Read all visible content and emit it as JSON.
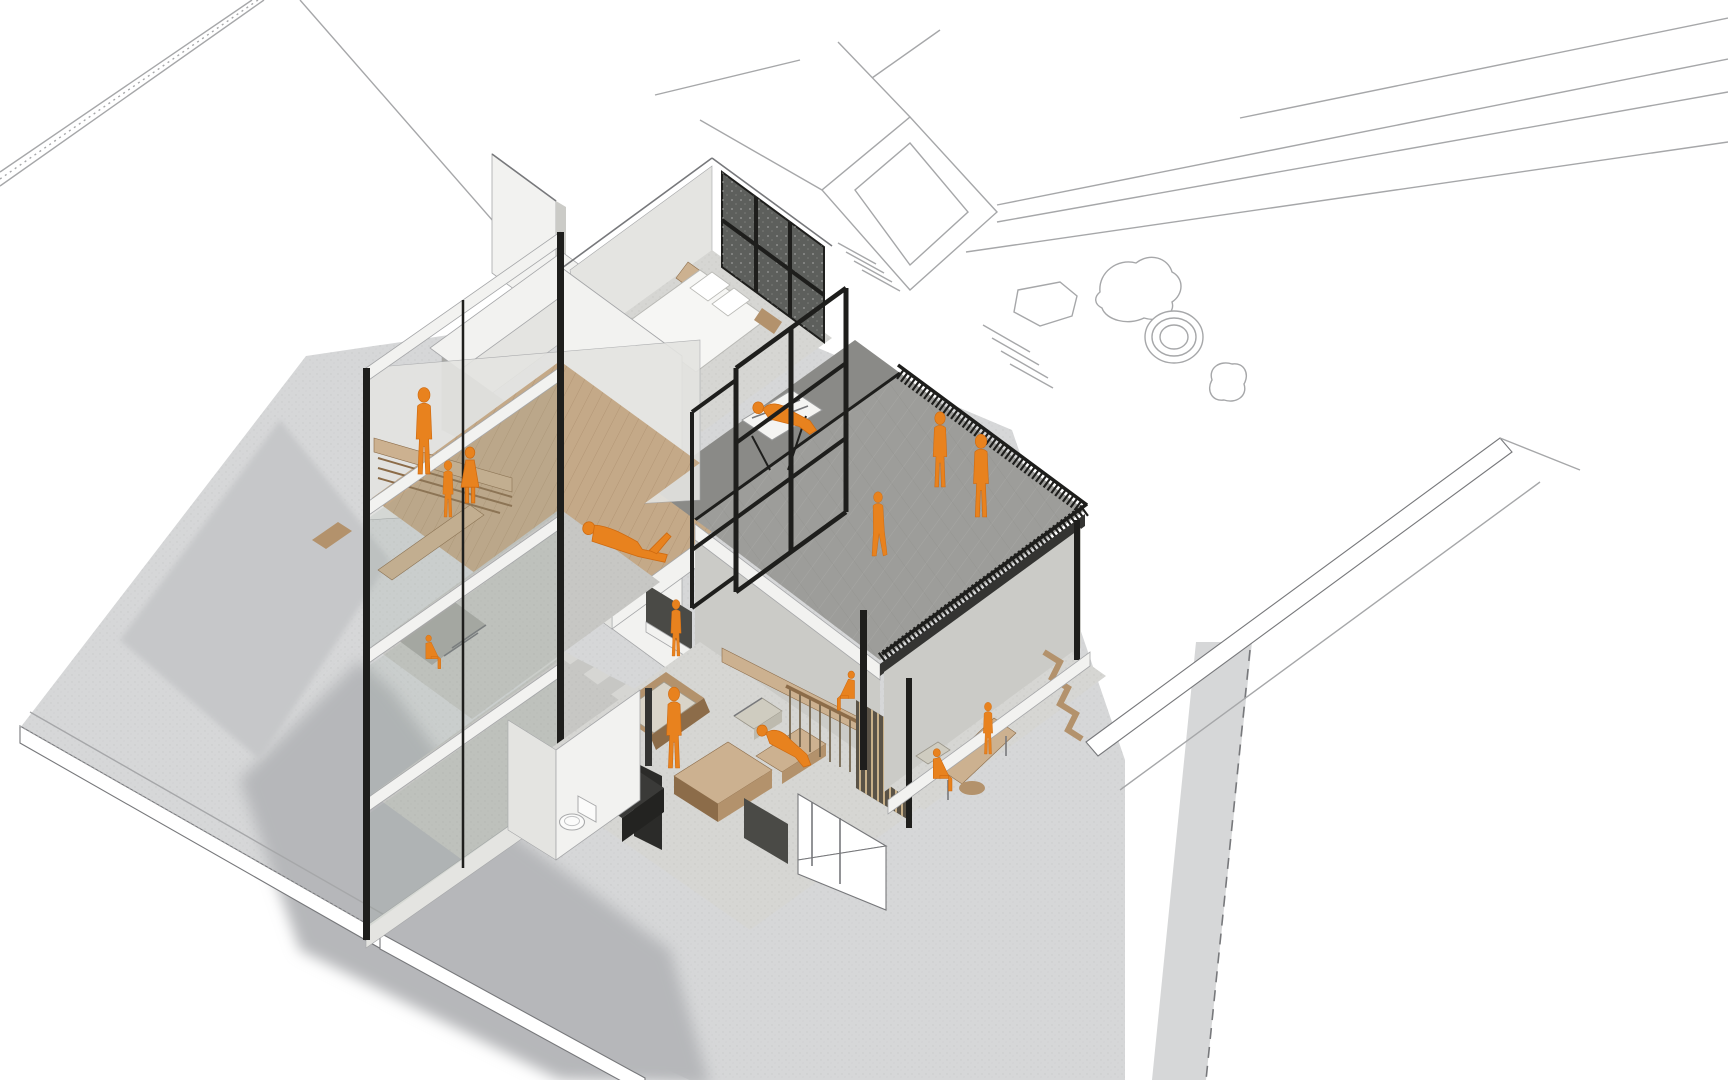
{
  "scene": {
    "description": "Axonometric cutaway rendering of a three-storey house: attic family room, bedroom, roof terrace with railing, mezzanine reading platform, double-height living room with wood stove, dining room below the terrace, set in a white line-drawn site plan with rocks, a round basin and boundary walls. Occupants shown as orange silhouettes.",
    "style_note": "monochrome concrete / white model with orange human figures",
    "rooms": [
      "attic family room",
      "bedroom",
      "roof terrace",
      "hammock balcony",
      "mezzanine study",
      "living room",
      "bathroom",
      "entry stair",
      "dining room"
    ],
    "figure_count": 15,
    "figures": [
      {
        "name": "parent-attic",
        "type": "stand",
        "x": 424,
        "y": 474,
        "s": 0.92
      },
      {
        "name": "child-attic",
        "type": "stand",
        "x": 448,
        "y": 517,
        "s": 0.6
      },
      {
        "name": "girl-attic",
        "type": "skirt",
        "x": 470,
        "y": 503,
        "s": 1.05
      },
      {
        "name": "child-pit",
        "type": "sit",
        "x": 428,
        "y": 660,
        "s": 0.62,
        "flip": true
      },
      {
        "name": "child-window",
        "type": "stand",
        "x": 676,
        "y": 656,
        "s": 0.6
      },
      {
        "name": "reader-mezzanine",
        "type": "lie",
        "x": 626,
        "y": 548,
        "s": 1.15,
        "rot": 17
      },
      {
        "name": "adult-living",
        "type": "stand",
        "x": 674,
        "y": 768,
        "s": 0.86
      },
      {
        "name": "lounger-chaise",
        "type": "recline",
        "x": 784,
        "y": 752,
        "s": 1.0,
        "rot": 6
      },
      {
        "name": "lounger-hammock",
        "type": "recline",
        "x": 786,
        "y": 424,
        "s": 1.05,
        "rot": -8
      },
      {
        "name": "walker-terrace",
        "type": "walk",
        "x": 878,
        "y": 556,
        "s": 0.7
      },
      {
        "name": "adult-terrace-1",
        "type": "stand",
        "x": 940,
        "y": 487,
        "s": 0.8
      },
      {
        "name": "adult-terrace-2",
        "type": "stand",
        "x": 981,
        "y": 517,
        "s": 0.88
      },
      {
        "name": "diner-sitting",
        "type": "sit",
        "x": 936,
        "y": 780,
        "s": 0.78,
        "flip": true
      },
      {
        "name": "diner-standing",
        "type": "stand",
        "x": 988,
        "y": 754,
        "s": 0.55
      },
      {
        "name": "bar-sitting",
        "type": "sit",
        "x": 852,
        "y": 700,
        "s": 0.72
      }
    ]
  },
  "colors": {
    "canvas": "#ffffff",
    "white": "#ffffff",
    "line": "#a6a7a9",
    "line_dark": "#77787b",
    "ground": "#d6d7d8",
    "ground_edge": "#c6c7c9",
    "shadow": "#b6b7ba",
    "wall_white": "#f2f2f0",
    "wall_light": "#e4e4e1",
    "wall_shade": "#cbcbc7",
    "wall_dark": "#a8a8a4",
    "wall_deep": "#8e8e8a",
    "conc_floor": "#c7c7c4",
    "conc_light": "#d6d6d3",
    "deck": "#9d9d9a",
    "deck_dark": "#8a8a87",
    "steel": "#1e1e1c",
    "steel_soft": "#343432",
    "glass": "#8fa193",
    "glazing_dark": "#5d5f5c",
    "wood_light": "#ccb190",
    "wood_mid": "#b3926c",
    "wood_dark": "#8c6c49",
    "wood_floor": "#c4a988",
    "orange": "#e8821e",
    "orange_deep": "#cf6a10"
  }
}
